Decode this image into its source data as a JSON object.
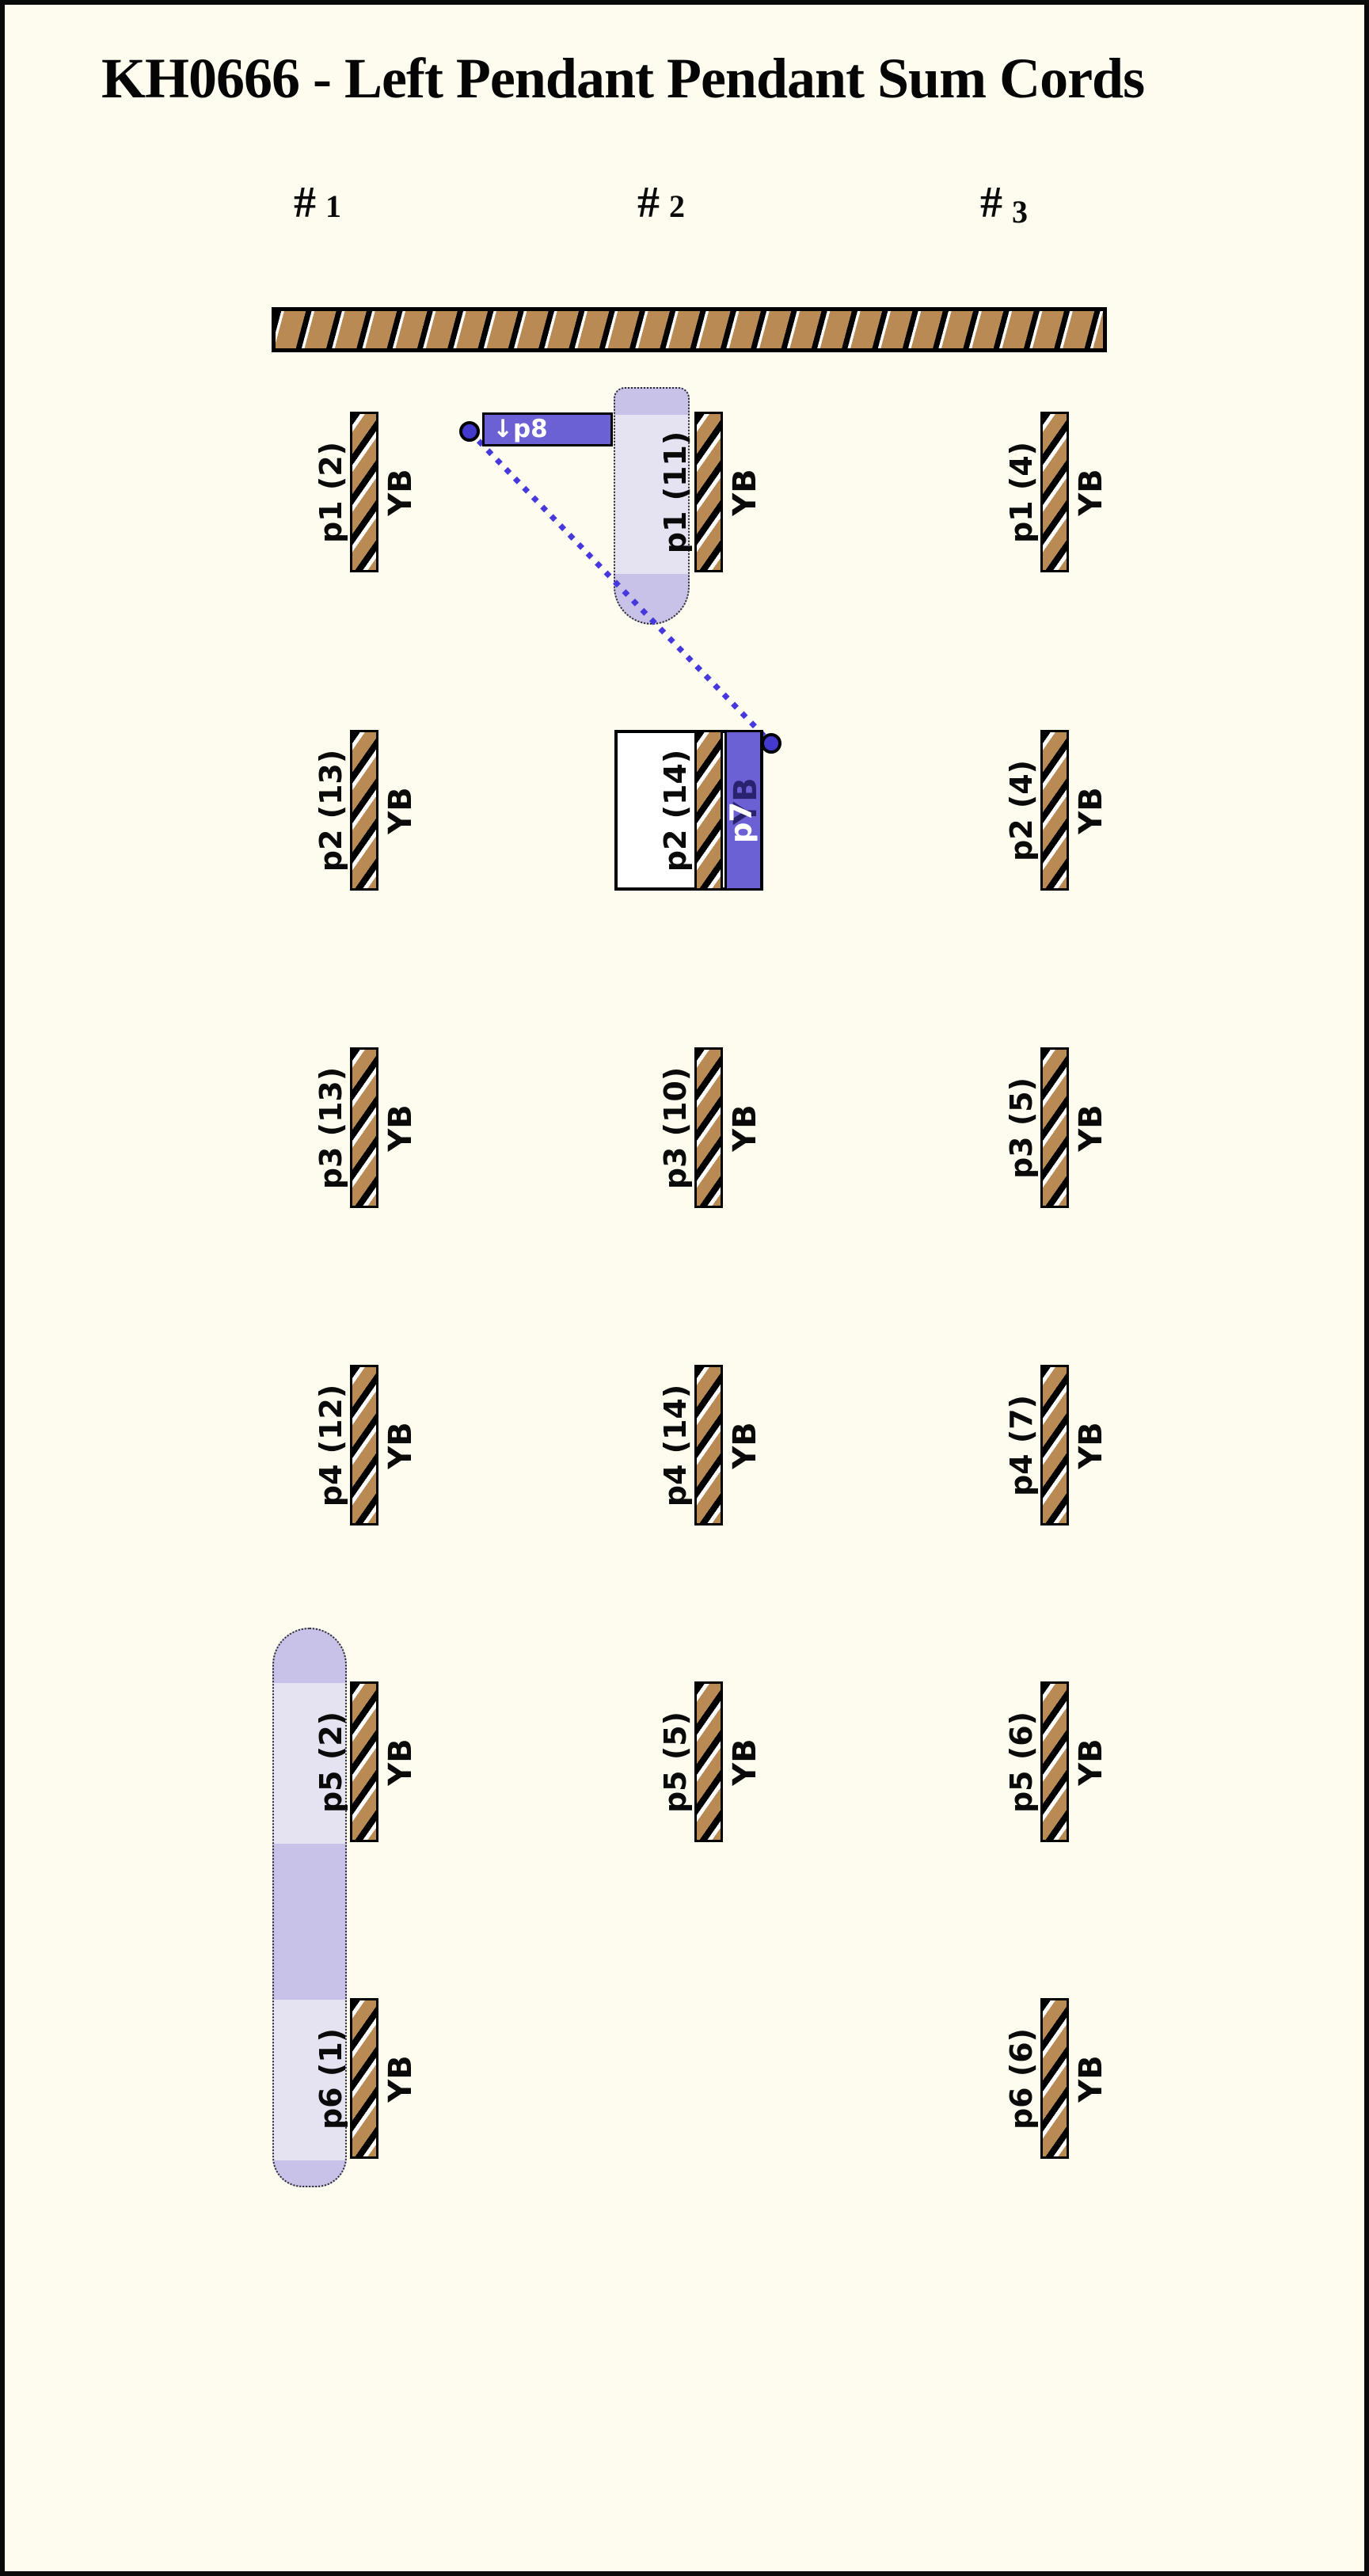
{
  "title": "KH0666 - Left Pendant Pendant Sum Cords",
  "columns": [
    {
      "header_hash": "#",
      "header_num": "1",
      "pendants": [
        {
          "label": "p1 (2)",
          "code": "YB"
        },
        {
          "label": "p2 (13)",
          "code": "YB"
        },
        {
          "label": "p3 (13)",
          "code": "YB"
        },
        {
          "label": "p4 (12)",
          "code": "YB"
        },
        {
          "label": "p5 (2)",
          "code": "YB"
        },
        {
          "label": "p6 (1)",
          "code": "YB"
        }
      ]
    },
    {
      "header_hash": "#",
      "header_num": "2",
      "pendants": [
        {
          "label": "p1 (11)",
          "code": "YB"
        },
        {
          "label": "p2 (14)",
          "code": "YB"
        },
        {
          "label": "p3 (10)",
          "code": "YB"
        },
        {
          "label": "p4 (14)",
          "code": "YB"
        },
        {
          "label": "p5 (5)",
          "code": "YB"
        }
      ]
    },
    {
      "header_hash": "#",
      "header_num": "3",
      "pendants": [
        {
          "label": "p1 (4)",
          "code": "YB"
        },
        {
          "label": "p2 (4)",
          "code": "YB"
        },
        {
          "label": "p3 (5)",
          "code": "YB"
        },
        {
          "label": "p4 (7)",
          "code": "YB"
        },
        {
          "label": "p5 (6)",
          "code": "YB"
        },
        {
          "label": "p6 (6)",
          "code": "YB"
        }
      ]
    }
  ],
  "annotations": {
    "p8_box_label": "↓p8",
    "p7_bar_label": "p7",
    "p7_under_label": "YB"
  },
  "colors": {
    "background": "#FDFCEE",
    "cord_brown": "#BA8A54",
    "accent_purple": "#6B60D4",
    "circle_blue": "#4339CC",
    "line_blue": "#4638DC",
    "highlight_light": "#E5E2F2",
    "highlight_dark": "#C8C2E8"
  }
}
